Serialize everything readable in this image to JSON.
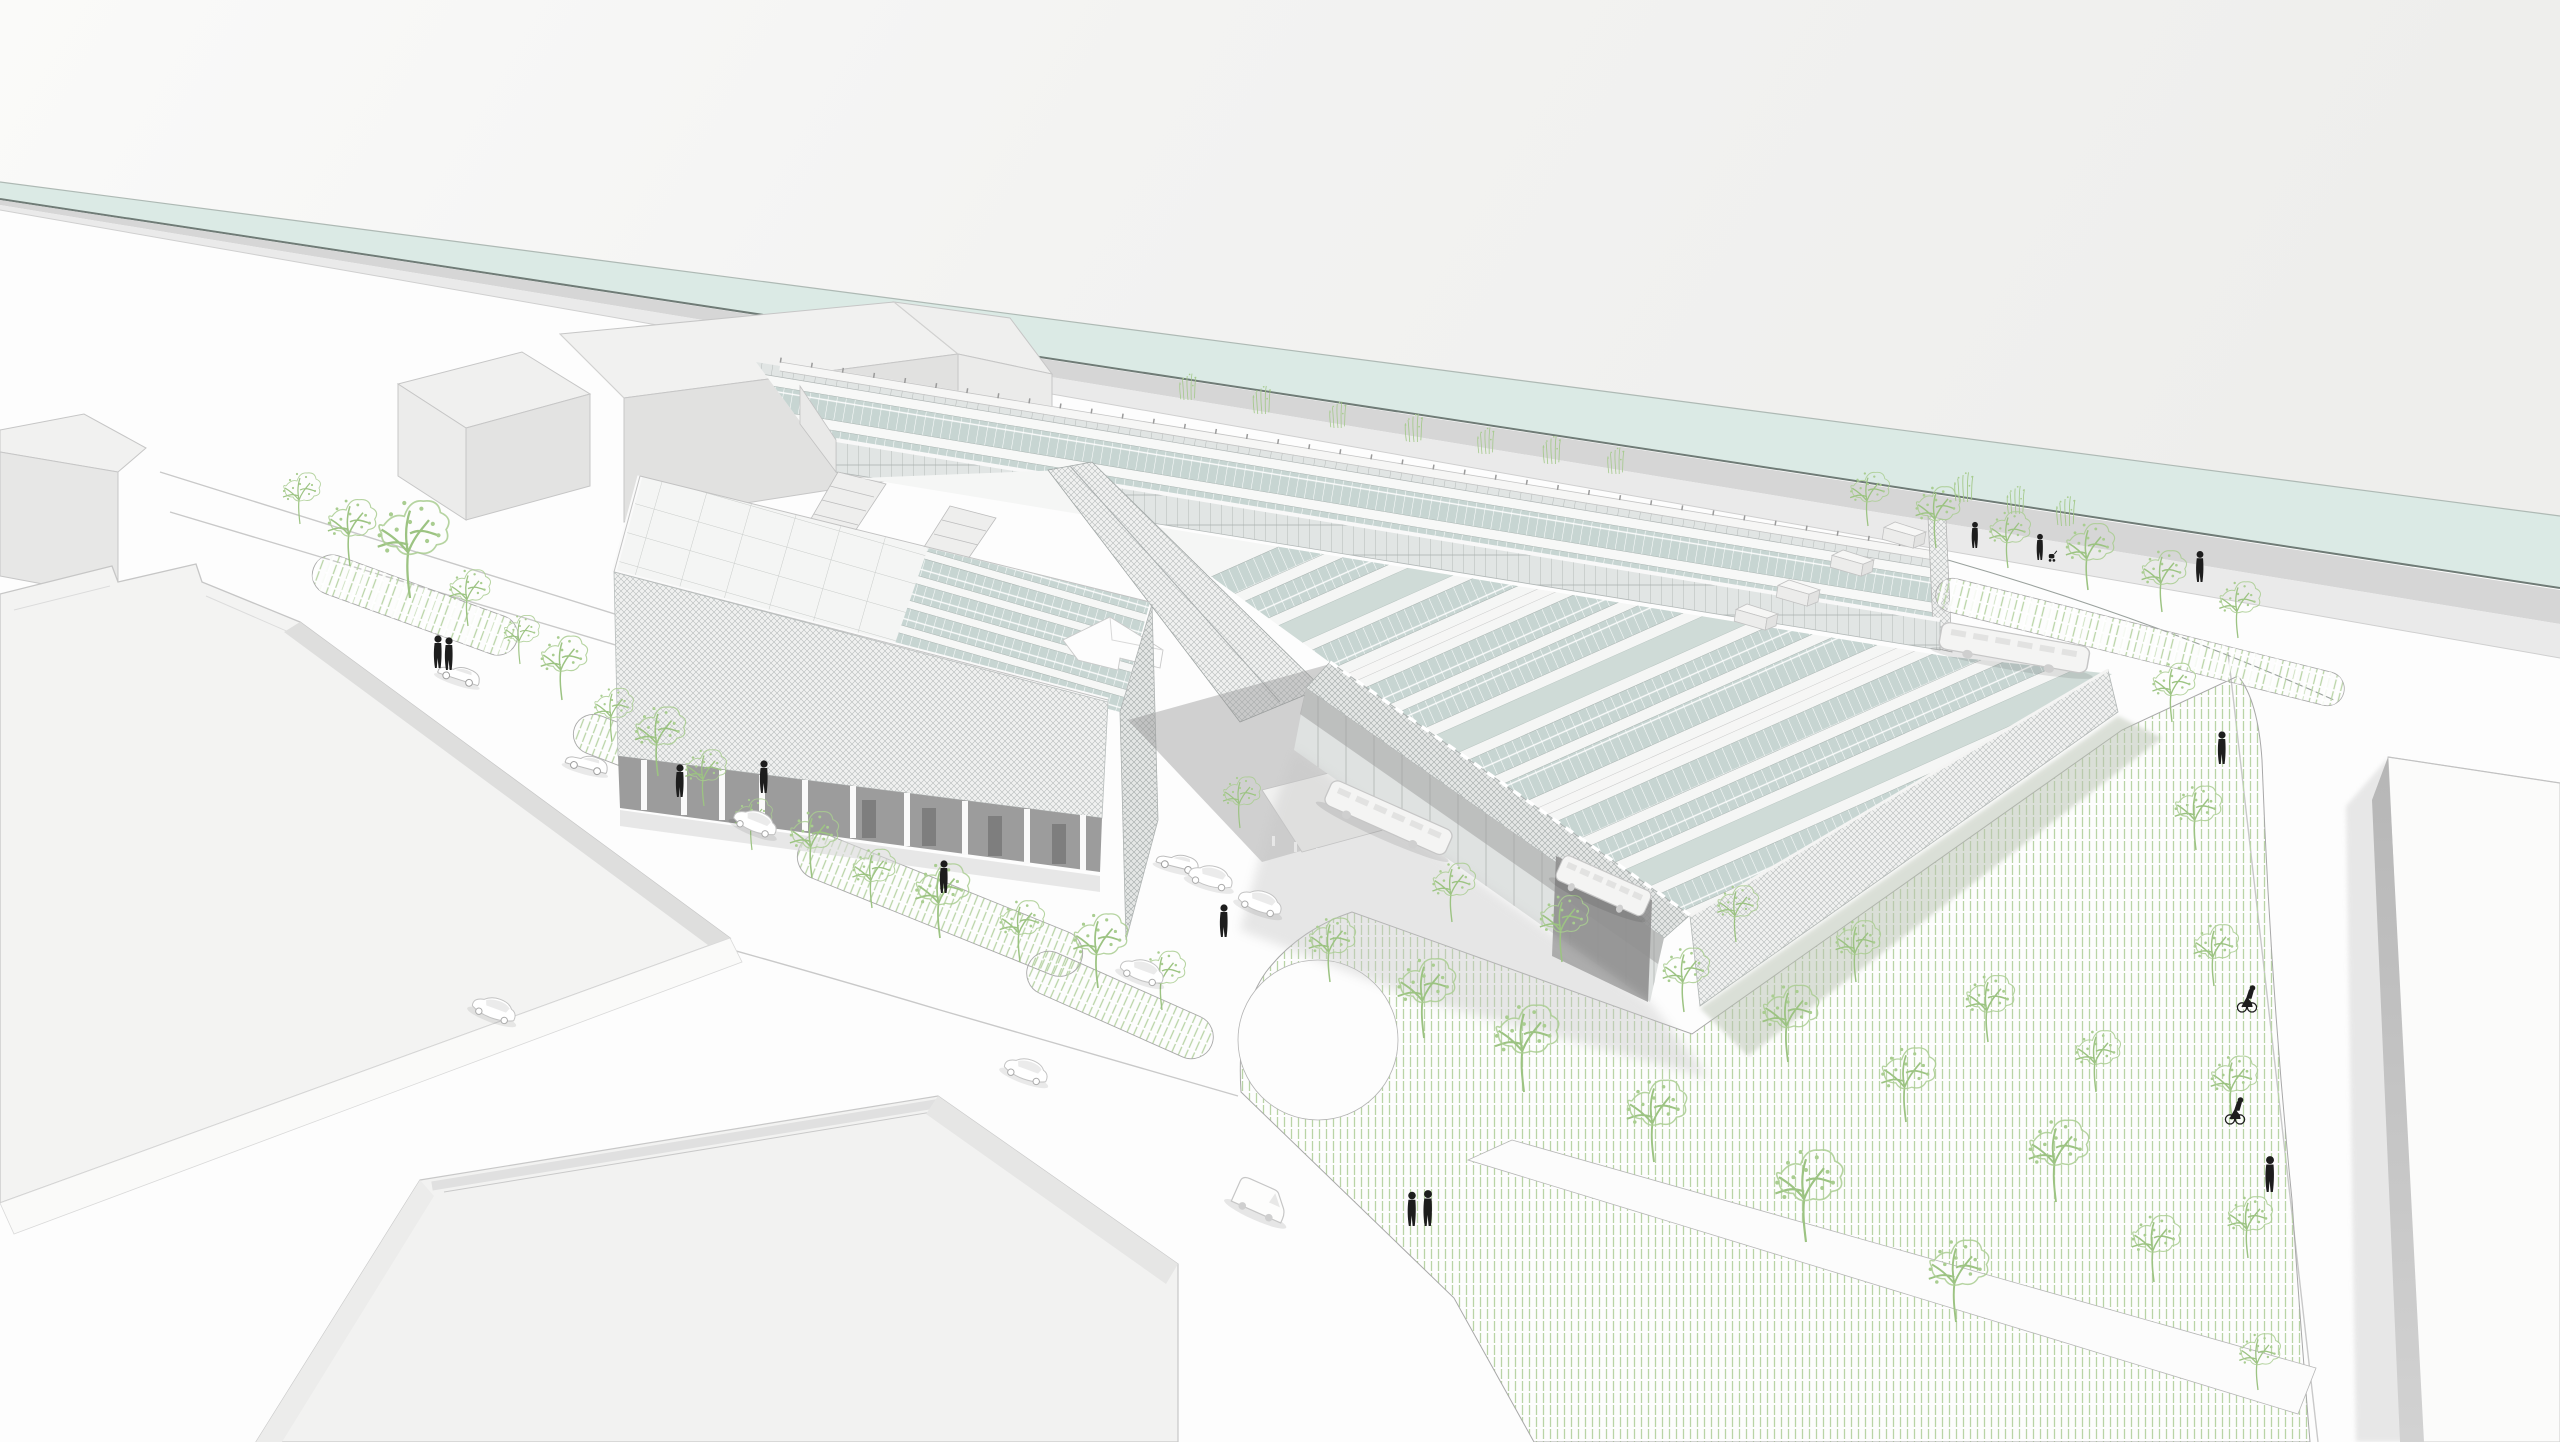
{
  "meta": {
    "title": "Aerial architectural rendering — riverside campus with solar sawtooth roofs",
    "view": "aerial perspective from south-west",
    "style": "white line-art architectural visualization"
  },
  "palette": {
    "sky_left": "#f9f9f8",
    "sky_right": "#eeeeec",
    "water": "#dbeae5",
    "water_edge": "#6f7b76",
    "water_far_edge": "#aeb9b4",
    "towpath": "#cfcfcf",
    "towpath_light": "#eaeaea",
    "ground": "#fdfdfd",
    "roof_white": "#f3f3f2",
    "wall_light": "#e4e4e3",
    "wall_shade": "#dededd",
    "outline": "#c6c6c6",
    "mesh_line": "#b4bab9",
    "mesh_line_dark": "#a3a9a8",
    "mesh_bg": "#f0f1f0",
    "mesh_bg_dark": "#e4e6e5",
    "solar": "#c7d5d2",
    "solar_plain": "#cfdbd7",
    "solar_joint": "#ffffff",
    "clerestory_bg": "#e1e5e4",
    "clerestory_line": "#aab0af",
    "glass": "#dfe2e1",
    "mullion": "#b4b8b7",
    "shadow_dark": "#9c9c9c",
    "shadow_soft": "#c7c7c7",
    "green_hatch": "#b9d4a6",
    "tree_green": "#9cc382",
    "park_outline": "#a8a8a8",
    "road_line": "#c9c9c9",
    "figure": "#1d1d1d",
    "vehicle_outline": "#bdbdbd"
  },
  "scene": {
    "counts": {
      "people": 13,
      "cyclists": 2,
      "strollers": 1,
      "cars": 9,
      "buses": 3,
      "vans": 1,
      "trees": 46,
      "shrubs": 10,
      "rooftop_units": 4
    },
    "people": [
      [
        438,
        668,
        1
      ],
      [
        449,
        670,
        1
      ],
      [
        680,
        797,
        1
      ],
      [
        764,
        793,
        1
      ],
      [
        944,
        893,
        1
      ],
      [
        1224,
        937,
        1
      ],
      [
        1412,
        1226,
        1.05
      ],
      [
        1428,
        1226,
        1.1
      ],
      [
        1975,
        548,
        0.8
      ],
      [
        2040,
        560,
        0.8
      ],
      [
        2200,
        582,
        0.95
      ],
      [
        2222,
        764,
        1.0
      ],
      [
        2270,
        1192,
        1.1
      ]
    ],
    "cyclists": [
      [
        2247,
        1012,
        1
      ],
      [
        2235,
        1124,
        1
      ]
    ],
    "strollers": [
      [
        2052,
        562,
        0.8
      ]
    ],
    "cars": [
      [
        457,
        681,
        18,
        0
      ],
      [
        585,
        770,
        15,
        0
      ],
      [
        753,
        829,
        22,
        1
      ],
      [
        492,
        1016,
        20,
        1
      ],
      [
        1024,
        1077,
        20,
        1
      ],
      [
        1176,
        869,
        14,
        0
      ],
      [
        1209,
        884,
        16,
        1
      ],
      [
        1258,
        909,
        20,
        1
      ],
      [
        1140,
        978,
        20,
        1
      ]
    ],
    "buses": [
      [
        2012,
        661,
        10,
        1.25
      ],
      [
        1383,
        830,
        24,
        1.1
      ],
      [
        1598,
        898,
        24,
        0.8
      ]
    ],
    "vans": [
      [
        1256,
        1212,
        24
      ]
    ],
    "trees": [
      [
        410,
        598,
        1.9
      ],
      [
        350,
        566,
        1.3
      ],
      [
        300,
        524,
        1.0
      ],
      [
        468,
        626,
        1.1
      ],
      [
        520,
        664,
        0.95
      ],
      [
        562,
        700,
        1.25
      ],
      [
        612,
        742,
        1.05
      ],
      [
        658,
        776,
        1.35
      ],
      [
        704,
        806,
        1.1
      ],
      [
        752,
        850,
        1.0
      ],
      [
        812,
        878,
        1.3
      ],
      [
        872,
        908,
        1.15
      ],
      [
        940,
        938,
        1.45
      ],
      [
        1020,
        962,
        1.2
      ],
      [
        1098,
        988,
        1.45
      ],
      [
        1162,
        1010,
        1.15
      ],
      [
        1240,
        828,
        1.0
      ],
      [
        1330,
        982,
        1.25
      ],
      [
        1424,
        1038,
        1.55
      ],
      [
        1524,
        1092,
        1.7
      ],
      [
        1654,
        1162,
        1.6
      ],
      [
        1806,
        1242,
        1.8
      ],
      [
        1956,
        1322,
        1.6
      ],
      [
        1452,
        922,
        1.15
      ],
      [
        1562,
        962,
        1.3
      ],
      [
        1684,
        1012,
        1.25
      ],
      [
        1788,
        1062,
        1.5
      ],
      [
        1906,
        1122,
        1.45
      ],
      [
        2056,
        1202,
        1.6
      ],
      [
        2154,
        1282,
        1.3
      ],
      [
        1736,
        942,
        1.1
      ],
      [
        1856,
        982,
        1.2
      ],
      [
        1988,
        1042,
        1.3
      ],
      [
        2096,
        1092,
        1.2
      ],
      [
        1868,
        526,
        1.05
      ],
      [
        1936,
        548,
        1.2
      ],
      [
        2008,
        568,
        1.1
      ],
      [
        2088,
        590,
        1.3
      ],
      [
        2162,
        612,
        1.2
      ],
      [
        2238,
        638,
        1.1
      ],
      [
        2172,
        722,
        1.15
      ],
      [
        2196,
        850,
        1.25
      ],
      [
        2214,
        986,
        1.2
      ],
      [
        2232,
        1120,
        1.25
      ],
      [
        2248,
        1258,
        1.2
      ],
      [
        2258,
        1390,
        1.1
      ]
    ],
    "shrubs": [
      [
        1188,
        400,
        0.8
      ],
      [
        1262,
        414,
        0.85
      ],
      [
        1338,
        428,
        0.8
      ],
      [
        1414,
        442,
        0.85
      ],
      [
        1486,
        454,
        0.8
      ],
      [
        1552,
        464,
        0.85
      ],
      [
        1616,
        474,
        0.8
      ],
      [
        1964,
        502,
        0.9
      ],
      [
        2016,
        514,
        0.85
      ],
      [
        2066,
        526,
        0.9
      ]
    ],
    "rooftop_units": [
      [
        1900,
        542
      ],
      [
        1848,
        570
      ],
      [
        1794,
        600
      ],
      [
        1752,
        624
      ]
    ]
  }
}
